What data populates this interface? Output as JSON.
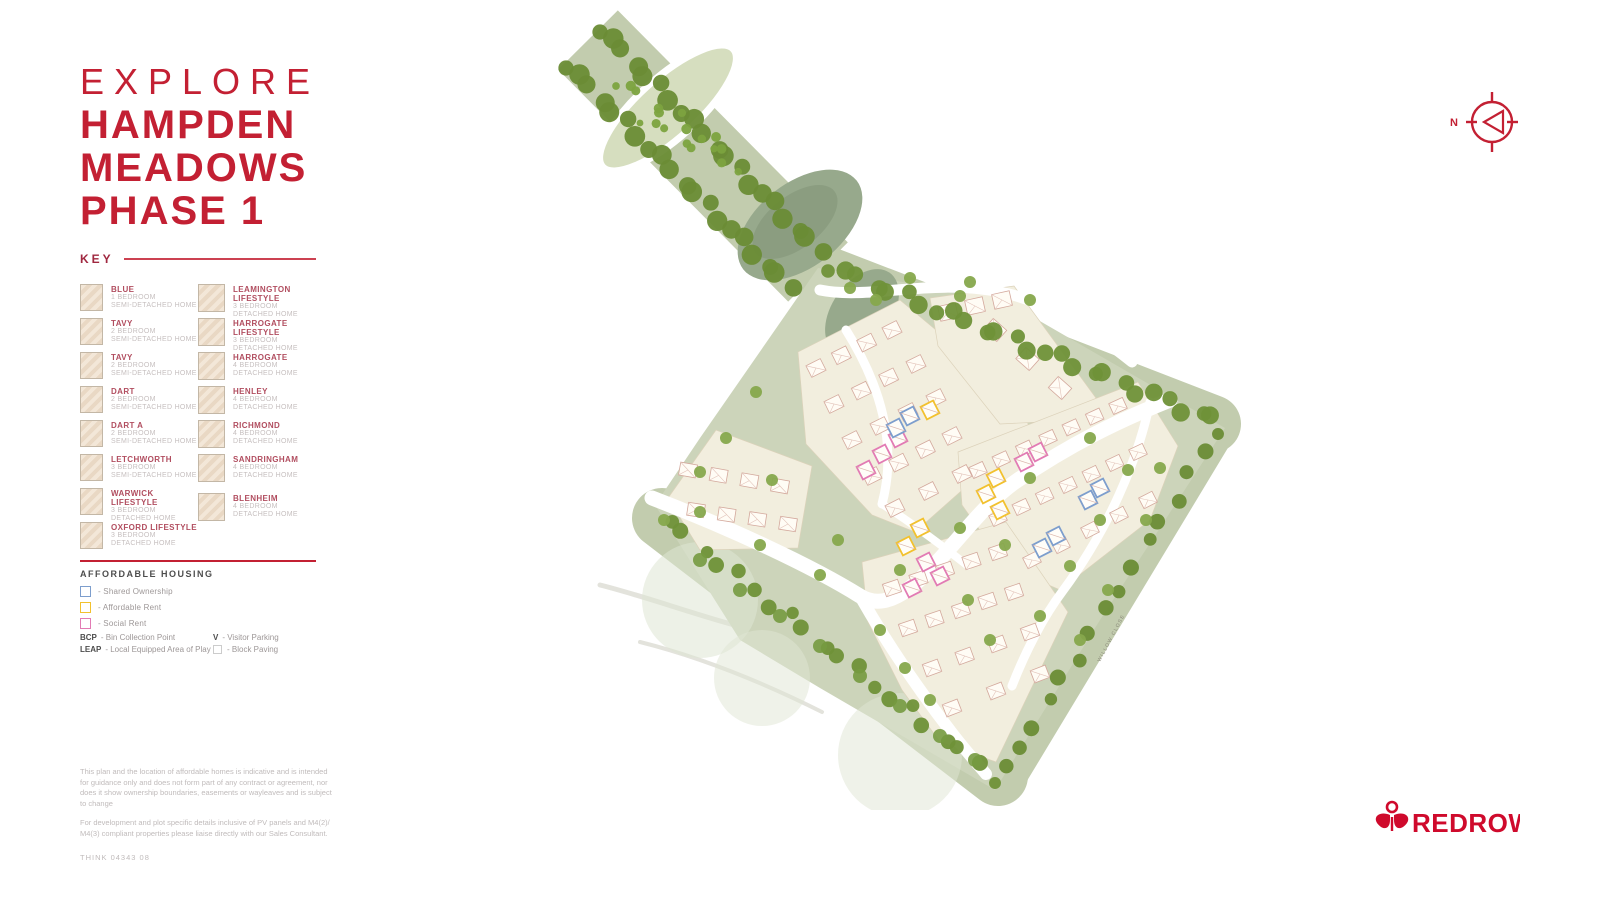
{
  "brand": {
    "name": "REDROW",
    "color": "#cf0a2c"
  },
  "header": {
    "kicker": "EXPLORE",
    "title_lines": [
      "HAMPDEN",
      "MEADOWS",
      "PHASE 1"
    ]
  },
  "key": {
    "heading": "KEY",
    "left": [
      {
        "name": "BLUE",
        "beds": "1 BEDROOM",
        "type": "SEMI-DETACHED HOME"
      },
      {
        "name": "TAVY",
        "beds": "2 BEDROOM",
        "type": "SEMI-DETACHED HOME"
      },
      {
        "name": "TAVY",
        "beds": "2 BEDROOM",
        "type": "SEMI-DETACHED HOME"
      },
      {
        "name": "DART",
        "beds": "2 BEDROOM",
        "type": "SEMI-DETACHED HOME"
      },
      {
        "name": "DART A",
        "beds": "2 BEDROOM",
        "type": "SEMI-DETACHED HOME"
      },
      {
        "name": "LETCHWORTH",
        "beds": "3 BEDROOM",
        "type": "SEMI-DETACHED HOME"
      },
      {
        "name": "WARWICK LIFESTYLE",
        "beds": "3 BEDROOM",
        "type": "DETACHED HOME"
      },
      {
        "name": "OXFORD LIFESTYLE",
        "beds": "3 BEDROOM",
        "type": "DETACHED HOME"
      }
    ],
    "right": [
      {
        "name": "LEAMINGTON LIFESTYLE",
        "beds": "3 BEDROOM",
        "type": "DETACHED HOME"
      },
      {
        "name": "HARROGATE LIFESTYLE",
        "beds": "3 BEDROOM",
        "type": "DETACHED HOME"
      },
      {
        "name": "HARROGATE",
        "beds": "4 BEDROOM",
        "type": "DETACHED HOME"
      },
      {
        "name": "HENLEY",
        "beds": "4 BEDROOM",
        "type": "DETACHED HOME"
      },
      {
        "name": "RICHMOND",
        "beds": "4 BEDROOM",
        "type": "DETACHED HOME"
      },
      {
        "name": "SANDRINGHAM",
        "beds": "4 BEDROOM",
        "type": "DETACHED HOME"
      },
      {
        "name": "BLENHEIM",
        "beds": "4 BEDROOM",
        "type": "DETACHED HOME"
      }
    ]
  },
  "affordable": {
    "heading": "AFFORDABLE HOUSING",
    "items": [
      {
        "label": "- Shared Ownership",
        "color": "#7d9ecd"
      },
      {
        "label": "- Affordable Rent",
        "color": "#f2c12e"
      },
      {
        "label": "- Social Rent",
        "color": "#e27bb4"
      }
    ],
    "notes_left": [
      {
        "abbr": "BCP",
        "text": "- Bin Collection Point"
      },
      {
        "abbr": "LEAP",
        "text": "- Local Equipped Area of Play"
      }
    ],
    "notes_right": [
      {
        "abbr": "V",
        "text": "- Visitor Parking"
      },
      {
        "abbr": "",
        "text": "- Block Paving"
      }
    ]
  },
  "disclaimer": {
    "p1": "This plan and the location of affordable homes is indicative and is intended for guidance only and does not form part of any contract or agreement, nor does it show ownership boundaries, easements or wayleaves and is subject to change",
    "p2": "For development and plot specific details inclusive of PV panels and M4(2)/ M4(3) compliant properties please liaise directly with our Sales Consultant.",
    "ref": "THINK   04343 08"
  },
  "compass": {
    "north_label": "N"
  },
  "map": {
    "road_label": "WILLOW CLOSE"
  }
}
